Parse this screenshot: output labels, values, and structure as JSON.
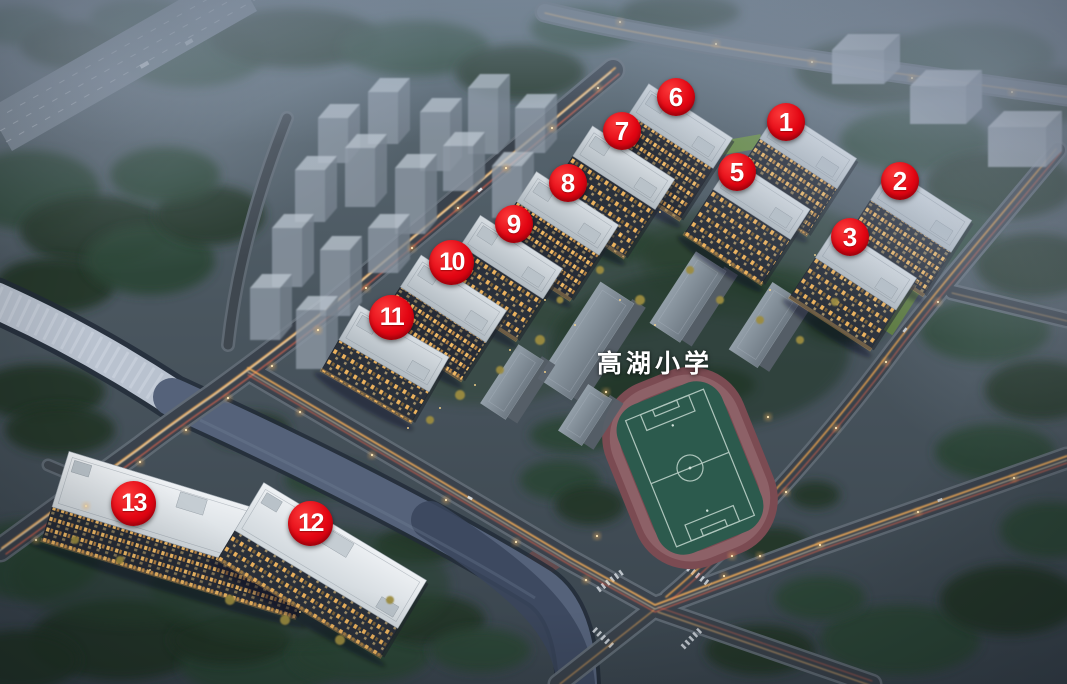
{
  "scene": {
    "description": "Dusk aerial 3D rendering of a residential development site plan with numbered buildings, a primary school and a running-track soccer field",
    "school_label": "高湖小学",
    "marker_color": "#e30613",
    "marker_text_color": "#ffffff",
    "pitch_color": "#2c5a4d",
    "track_color": "#7b4b52"
  },
  "markers": [
    {
      "id": "building-1",
      "label": "1"
    },
    {
      "id": "building-2",
      "label": "2"
    },
    {
      "id": "building-3",
      "label": "3"
    },
    {
      "id": "building-5",
      "label": "5"
    },
    {
      "id": "building-6",
      "label": "6"
    },
    {
      "id": "building-7",
      "label": "7"
    },
    {
      "id": "building-8",
      "label": "8"
    },
    {
      "id": "building-9",
      "label": "9"
    },
    {
      "id": "building-10",
      "label": "10"
    },
    {
      "id": "building-11",
      "label": "11"
    },
    {
      "id": "building-12",
      "label": "12"
    },
    {
      "id": "building-13",
      "label": "13"
    }
  ]
}
